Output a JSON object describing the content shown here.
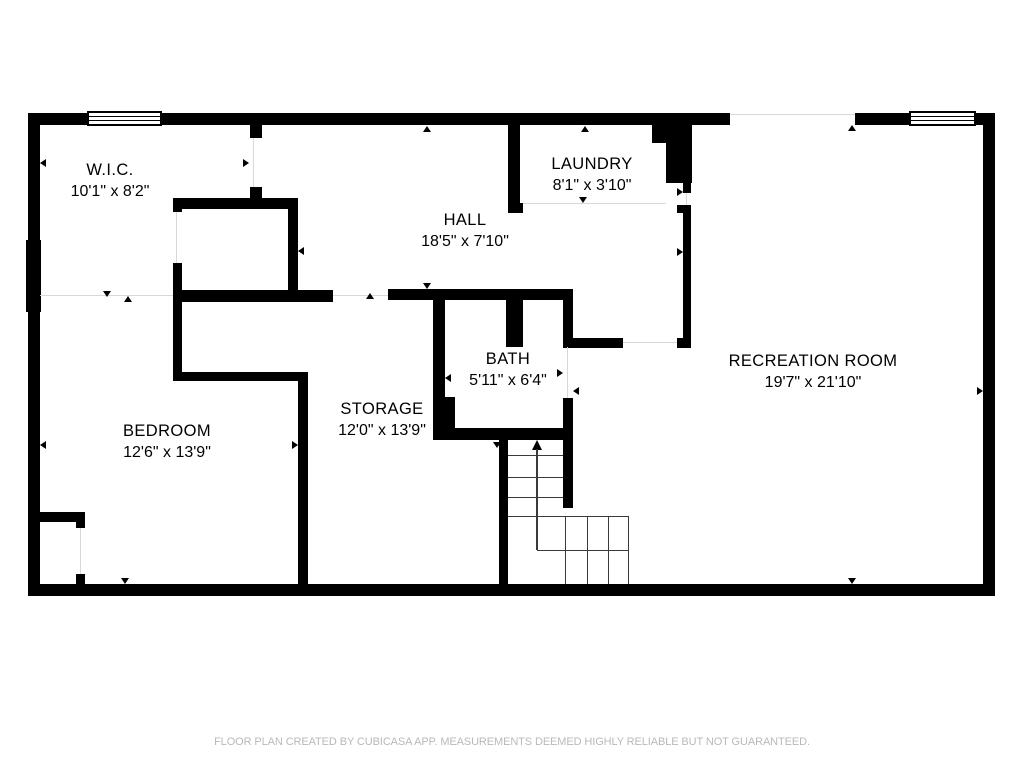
{
  "rooms": [
    {
      "name": "W.I.C.",
      "dims": "10'1\" x 8'2\""
    },
    {
      "name": "HALL",
      "dims": "18'5\" x 7'10\""
    },
    {
      "name": "LAUNDRY",
      "dims": "8'1\" x 3'10\""
    },
    {
      "name": "BATH",
      "dims": "5'11\" x 6'4\""
    },
    {
      "name": "STORAGE",
      "dims": "12'0\" x 13'9\""
    },
    {
      "name": "BEDROOM",
      "dims": "12'6\" x 13'9\""
    },
    {
      "name": "RECREATION ROOM",
      "dims": "19'7\" x 21'10\""
    }
  ],
  "stairs": {
    "direction_arrow": "up"
  },
  "footer": {
    "text": "FLOOR PLAN CREATED BY CUBICASA APP. MEASUREMENTS DEEMED HIGHLY RELIABLE BUT NOT GUARANTEED."
  },
  "colors": {
    "wall": "#000000",
    "opening_line": "#d8d8d8",
    "stair_line": "#3a3a3a",
    "footer_text": "#b9b9b9",
    "background": "#ffffff"
  }
}
